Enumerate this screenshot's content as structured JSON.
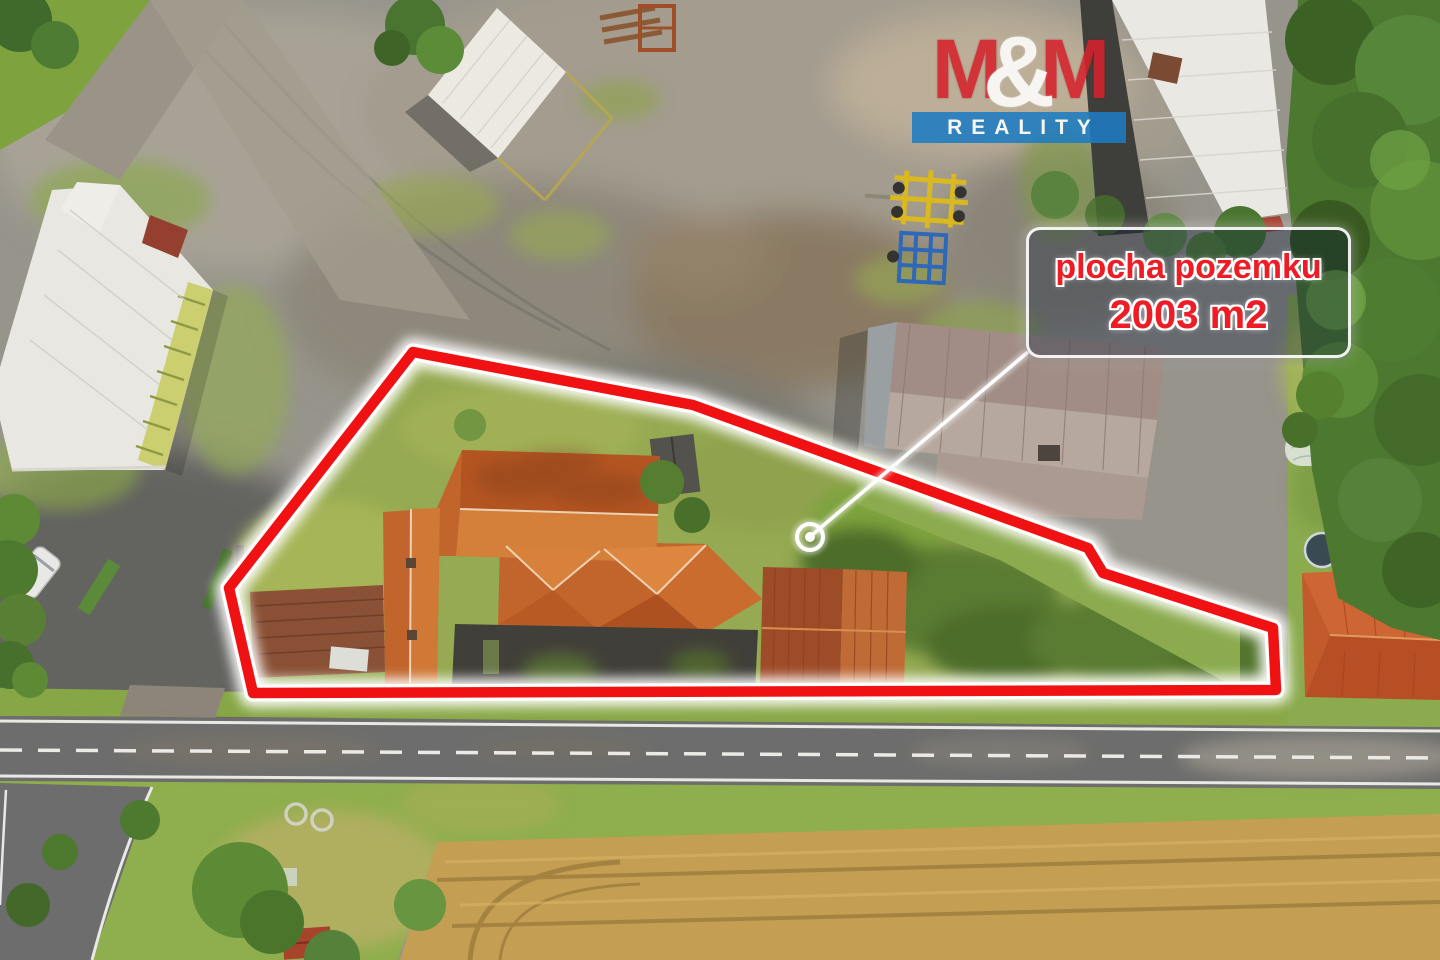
{
  "overlay": {
    "logo": {
      "m_left": "M",
      "ampersand": "&",
      "m_right": "M",
      "subtitle": "REALITY"
    },
    "area_label": {
      "line1": "plocha pozemku",
      "line2": "2003 m2"
    }
  },
  "colors": {
    "outline_red": "#f01212",
    "label_text_red": "#ee1c25",
    "logo_red": "#d5232d",
    "logo_blue": "#1e7dc2",
    "marker_white": "#ffffff"
  }
}
